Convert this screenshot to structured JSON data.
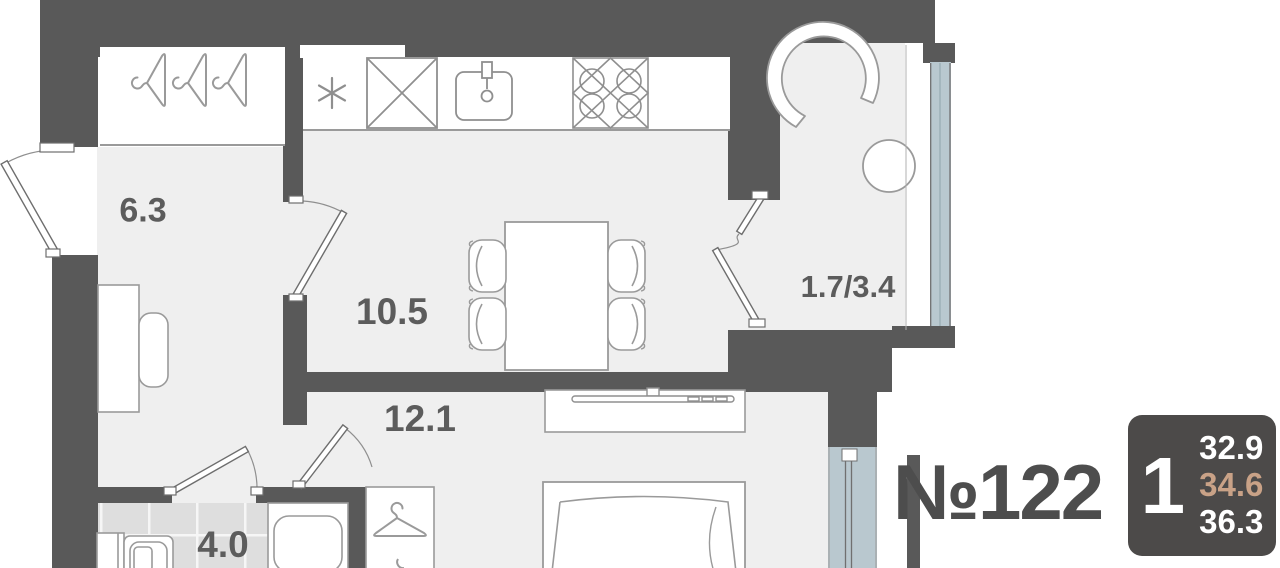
{
  "floorplan": {
    "title": "1-room apartment floor plan",
    "rooms": [
      {
        "name": "hallway",
        "area": "6.3"
      },
      {
        "name": "kitchen-living",
        "area": "10.5"
      },
      {
        "name": "room",
        "area": "12.1"
      },
      {
        "name": "bathroom",
        "area": "4.0"
      },
      {
        "name": "balcony",
        "area": "1.7/3.4"
      }
    ],
    "fixtures": [
      "hanger-icon",
      "fridge-asterisk-icon",
      "appliance-box-icon",
      "sink-icon",
      "stove-icon",
      "dining-table-icon",
      "chair-icon",
      "armchair-icon",
      "round-table-icon",
      "tv-stand-icon",
      "tv-icon",
      "bed-icon",
      "wardrobe-hanger-icon",
      "washbasin-icon",
      "washing-machine-icon",
      "bathtub-icon",
      "door-icon",
      "window-glazing-icon",
      "bench-icon"
    ]
  },
  "listing": {
    "apartment_number": "№122",
    "rooms_count": "1",
    "areas": {
      "living": "32.9",
      "middle": "34.6",
      "total": "36.3"
    }
  },
  "colors": {
    "wall": "#595959",
    "floor": "#efefef",
    "tile": "#dedede",
    "glazing": "#b9c8cf",
    "badge_bg": "#4c4a49",
    "accent": "#c9a287",
    "label_text": "#5c5c5c"
  }
}
